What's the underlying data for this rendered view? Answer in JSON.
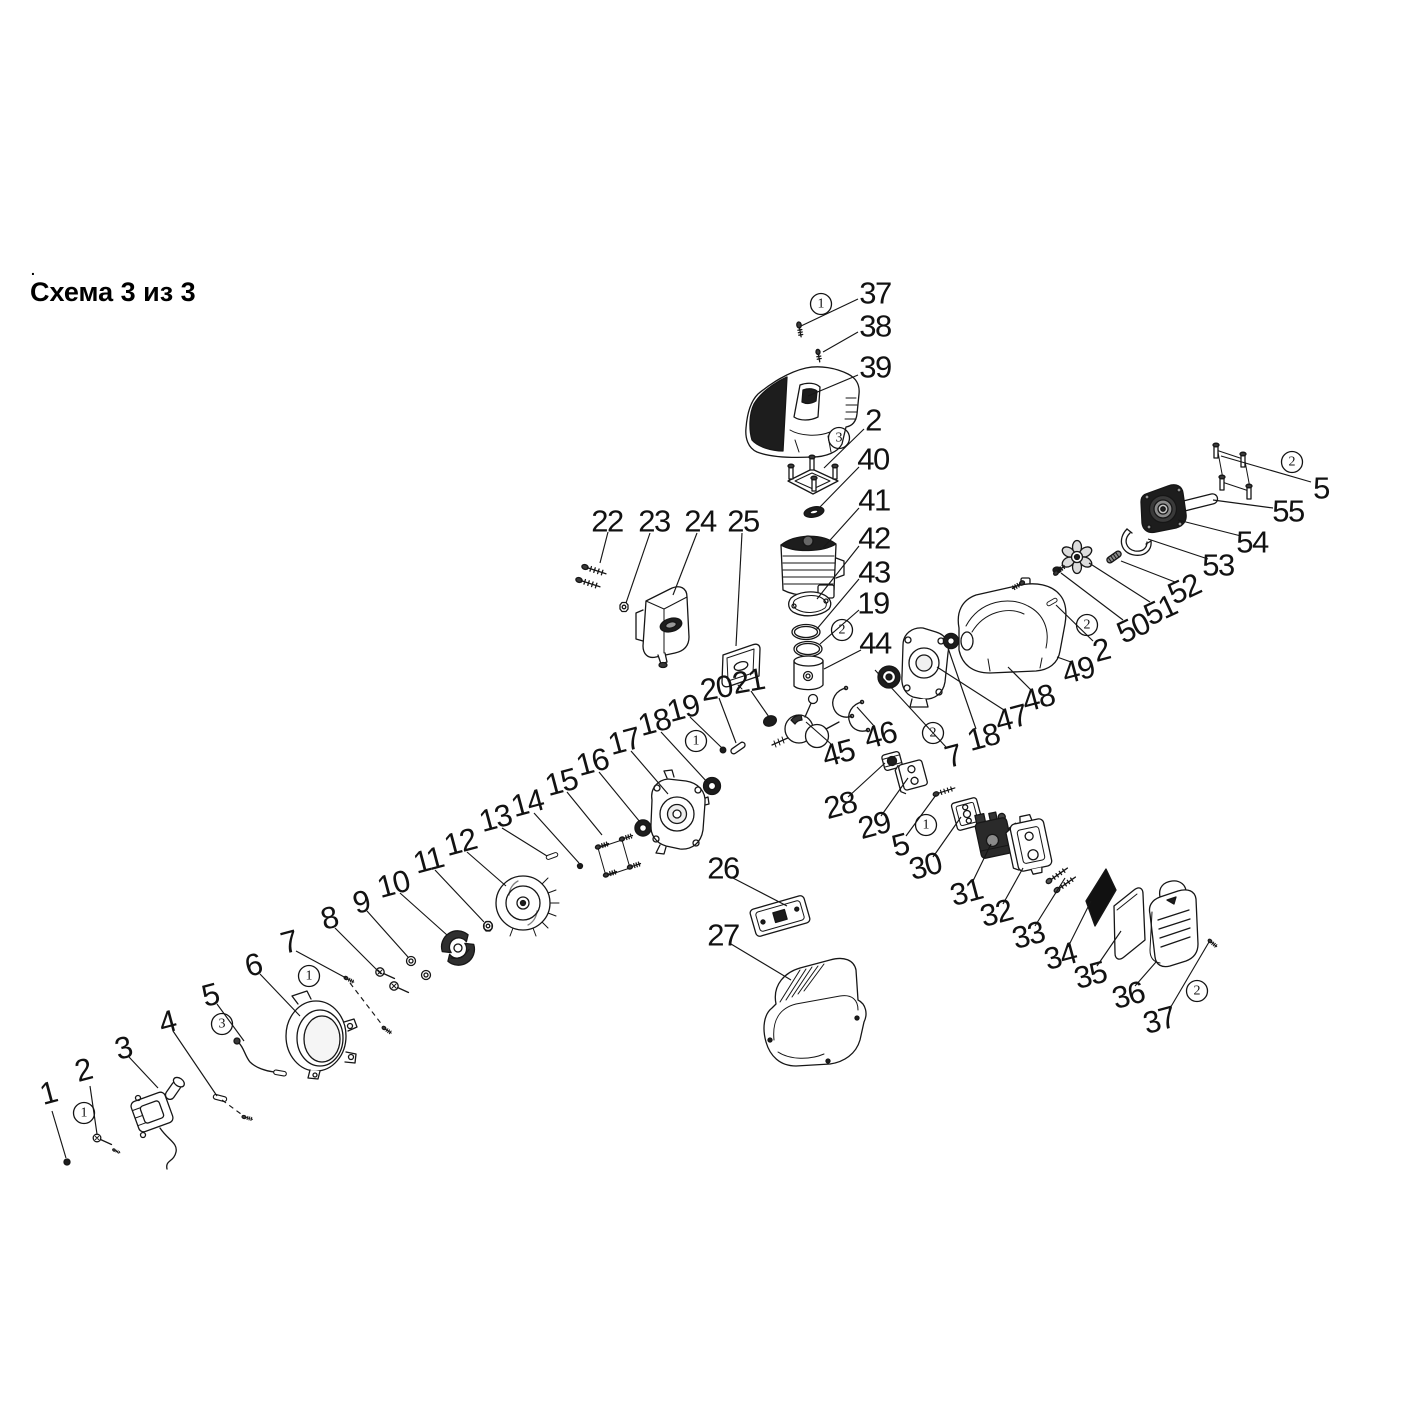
{
  "title": "Схема 3 из 3",
  "stray_mark": ".",
  "colors": {
    "ink": "#161616",
    "background": "#ffffff",
    "dark_fill": "#1d1d1d"
  },
  "diagram": {
    "labels": [
      [
        "37",
        875,
        293,
        0
      ],
      [
        "38",
        875,
        326,
        0
      ],
      [
        "39",
        875,
        367,
        0
      ],
      [
        "2",
        873,
        420,
        0
      ],
      [
        "40",
        873,
        459,
        0
      ],
      [
        "41",
        874,
        500,
        0
      ],
      [
        "42",
        874,
        538,
        0
      ],
      [
        "43",
        874,
        572,
        0
      ],
      [
        "19",
        873,
        603,
        0
      ],
      [
        "44",
        875,
        643,
        0
      ],
      [
        "22",
        607,
        521,
        0
      ],
      [
        "23",
        654,
        521,
        0
      ],
      [
        "24",
        700,
        521,
        0
      ],
      [
        "25",
        743,
        521,
        0
      ],
      [
        "20",
        716,
        688,
        -10
      ],
      [
        "21",
        748,
        681,
        -10
      ],
      [
        "19",
        683,
        708,
        -15
      ],
      [
        "18",
        654,
        722,
        -15
      ],
      [
        "17",
        624,
        741,
        -15
      ],
      [
        "16",
        592,
        762,
        -15
      ],
      [
        "15",
        561,
        782,
        -15
      ],
      [
        "14",
        527,
        803,
        -15
      ],
      [
        "13",
        495,
        818,
        -15
      ],
      [
        "12",
        460,
        842,
        -15
      ],
      [
        "11",
        428,
        860,
        -15
      ],
      [
        "10",
        393,
        884,
        -15
      ],
      [
        "9",
        361,
        902,
        -15
      ],
      [
        "8",
        329,
        918,
        -15
      ],
      [
        "7",
        289,
        942,
        -15
      ],
      [
        "6",
        253,
        965,
        -15
      ],
      [
        "5",
        210,
        995,
        -15
      ],
      [
        "4",
        167,
        1022,
        -15
      ],
      [
        "3",
        123,
        1048,
        -15
      ],
      [
        "2",
        83,
        1070,
        -15
      ],
      [
        "1",
        48,
        1093,
        -15
      ],
      [
        "26",
        723,
        868,
        0
      ],
      [
        "27",
        723,
        935,
        0
      ],
      [
        "45",
        838,
        753,
        -15
      ],
      [
        "46",
        880,
        735,
        -15
      ],
      [
        "28",
        840,
        805,
        -15
      ],
      [
        "29",
        874,
        825,
        -15
      ],
      [
        "5",
        900,
        845,
        -15
      ],
      [
        "30",
        925,
        866,
        -15
      ],
      [
        "31",
        966,
        892,
        -15
      ],
      [
        "32",
        996,
        913,
        -15
      ],
      [
        "33",
        1028,
        935,
        -15
      ],
      [
        "34",
        1060,
        956,
        -15
      ],
      [
        "35",
        1090,
        975,
        -15
      ],
      [
        "36",
        1128,
        995,
        -15
      ],
      [
        "37",
        1159,
        1020,
        -15
      ],
      [
        "7",
        953,
        756,
        -15
      ],
      [
        "18",
        983,
        737,
        -15
      ],
      [
        "47",
        1011,
        718,
        -15
      ],
      [
        "48",
        1038,
        698,
        -15
      ],
      [
        "49",
        1078,
        670,
        -15
      ],
      [
        "2",
        1101,
        650,
        -15
      ],
      [
        "50",
        1133,
        628,
        -25
      ],
      [
        "51",
        1160,
        610,
        -25
      ],
      [
        "52",
        1184,
        589,
        -25
      ],
      [
        "53",
        1218,
        565,
        0
      ],
      [
        "54",
        1252,
        542,
        0
      ],
      [
        "55",
        1288,
        511,
        0
      ],
      [
        "5",
        1321,
        488,
        0
      ]
    ],
    "callouts": [
      [
        "1",
        821,
        304
      ],
      [
        "3",
        839,
        438
      ],
      [
        "2",
        842,
        630
      ],
      [
        "1",
        696,
        741
      ],
      [
        "1",
        309,
        976
      ],
      [
        "3",
        222,
        1024
      ],
      [
        "1",
        84,
        1113
      ],
      [
        "2",
        933,
        733
      ],
      [
        "1",
        926,
        825
      ],
      [
        "2",
        1087,
        625
      ],
      [
        "2",
        1292,
        462
      ],
      [
        "2",
        1197,
        991
      ]
    ],
    "leaders": [
      [
        858,
        299,
        801,
        326
      ],
      [
        858,
        332,
        823,
        352
      ],
      [
        858,
        375,
        808,
        396
      ],
      [
        864,
        429,
        824,
        468
      ],
      [
        859,
        467,
        819,
        508
      ],
      [
        859,
        508,
        823,
        548
      ],
      [
        859,
        546,
        817,
        599
      ],
      [
        859,
        579,
        816,
        630
      ],
      [
        859,
        610,
        820,
        644
      ],
      [
        861,
        650,
        824,
        669
      ],
      [
        608,
        532,
        600,
        563
      ],
      [
        650,
        533,
        626,
        603
      ],
      [
        697,
        533,
        673,
        595
      ],
      [
        742,
        533,
        736,
        646
      ],
      [
        719,
        698,
        736,
        743
      ],
      [
        751,
        691,
        769,
        717
      ],
      [
        690,
        717,
        722,
        748
      ],
      [
        661,
        732,
        708,
        783
      ],
      [
        631,
        751,
        668,
        794
      ],
      [
        599,
        772,
        640,
        822
      ],
      [
        567,
        792,
        602,
        835
      ],
      [
        534,
        813,
        579,
        863
      ],
      [
        502,
        828,
        547,
        856
      ],
      [
        467,
        852,
        506,
        886
      ],
      [
        435,
        870,
        484,
        922
      ],
      [
        400,
        893,
        447,
        935
      ],
      [
        367,
        911,
        408,
        957
      ],
      [
        335,
        928,
        381,
        974
      ],
      [
        296,
        951,
        346,
        978
      ],
      [
        260,
        974,
        300,
        1016
      ],
      [
        217,
        1004,
        244,
        1041
      ],
      [
        173,
        1031,
        217,
        1096
      ],
      [
        129,
        1057,
        158,
        1088
      ],
      [
        90,
        1086,
        97,
        1134
      ],
      [
        52,
        1111,
        66,
        1158
      ],
      [
        731,
        877,
        787,
        906
      ],
      [
        731,
        944,
        791,
        980
      ],
      [
        831,
        744,
        806,
        722
      ],
      [
        874,
        726,
        857,
        707
      ],
      [
        848,
        797,
        885,
        763
      ],
      [
        881,
        816,
        908,
        778
      ],
      [
        906,
        836,
        936,
        795
      ],
      [
        933,
        857,
        961,
        817
      ],
      [
        972,
        883,
        991,
        844
      ],
      [
        1003,
        904,
        1023,
        868
      ],
      [
        1035,
        926,
        1065,
        878
      ],
      [
        1068,
        947,
        1091,
        901
      ],
      [
        1097,
        966,
        1121,
        931
      ],
      [
        1135,
        986,
        1156,
        962
      ],
      [
        1169,
        1010,
        1209,
        942
      ],
      [
        946,
        747,
        875,
        670
      ],
      [
        976,
        729,
        947,
        645
      ],
      [
        1004,
        710,
        937,
        667
      ],
      [
        1031,
        690,
        1008,
        667
      ],
      [
        1071,
        662,
        1057,
        657
      ],
      [
        1093,
        641,
        1056,
        605
      ],
      [
        1123,
        620,
        1061,
        573
      ],
      [
        1150,
        602,
        1089,
        563
      ],
      [
        1175,
        582,
        1121,
        561
      ],
      [
        1208,
        559,
        1148,
        539
      ],
      [
        1241,
        536,
        1178,
        520
      ],
      [
        1273,
        508,
        1213,
        500
      ],
      [
        1311,
        482,
        1221,
        456
      ],
      [
        350,
        983,
        383,
        1026,
        1
      ],
      [
        222,
        1100,
        241,
        1114,
        1
      ]
    ],
    "parts": [
      "screw-37",
      "screw-38",
      "engine-top-cover-39",
      "stud-plate-2-40",
      "oval-seal-40",
      "cylinder-41",
      "base-gasket-42",
      "piston-rings-43-19",
      "piston-44",
      "crankshaft-45",
      "circlips-46",
      "main-bearing-7",
      "crankcase-right-47-48",
      "oil-seal-47",
      "fuel-tank-49",
      "fan-wheel-51",
      "screw-50",
      "pin-52",
      "clutch-spring-53",
      "clutch-drum-54-55",
      "mount-bracket-5-right",
      "muffler-bolts-22",
      "nut-23",
      "muffler-24",
      "muffler-gasket-25",
      "pin-20",
      "grommet-21",
      "dot-19",
      "oil-seal-18",
      "crankcase-left-17",
      "oil-seal-16",
      "bracket-15",
      "pin-13",
      "dot-14",
      "flywheel-12",
      "nut-11",
      "clutch-shoes-10",
      "washers-9",
      "bolts-8",
      "screw-7-left",
      "fan-cover-6",
      "throttle-rod-5-left",
      "rod-4",
      "ignition-coil-3",
      "bolt-2-left",
      "dot-1",
      "carb-gasket-26",
      "bottom-cover-27",
      "intake-grommet-28",
      "insulator-29",
      "screw-5-center",
      "carb-gasket-30",
      "carburetor-31",
      "filter-base-32",
      "filter-screws-33",
      "foam-element-34",
      "filter-element-35",
      "filter-cover-36",
      "screw-37-right"
    ]
  }
}
